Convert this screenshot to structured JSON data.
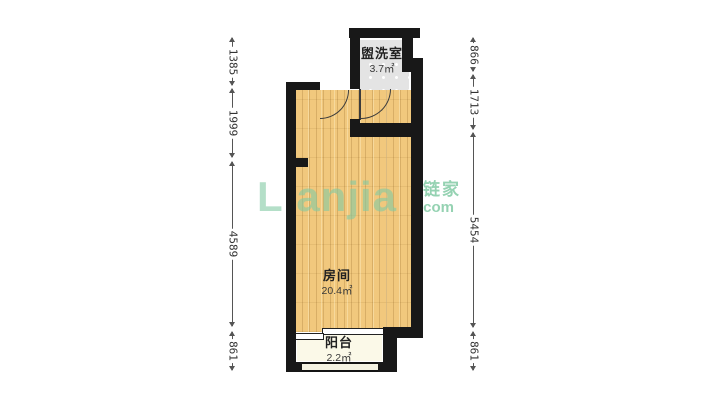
{
  "plan": {
    "rooms": [
      {
        "name": "盥洗室",
        "area": "3.7㎡"
      },
      {
        "name": "房间",
        "area": "20.4㎡"
      },
      {
        "name": "阳台",
        "area": "2.2㎡"
      }
    ],
    "dimensions_left": [
      "1385",
      "1999",
      "4589",
      "861"
    ],
    "dimensions_right": [
      "866",
      "1713",
      "5454",
      "861"
    ]
  },
  "watermark": {
    "brand_en": "Lianjia",
    "brand_cn": "链家",
    "suffix": ".com"
  },
  "colors": {
    "wall": "#181818",
    "wood_floor": "#f1c87d",
    "tile_floor": "#e4e4e4",
    "balcony_floor": "#fbf9e8",
    "watermark_green": "#82caa4",
    "dimension_text": "#333333"
  }
}
